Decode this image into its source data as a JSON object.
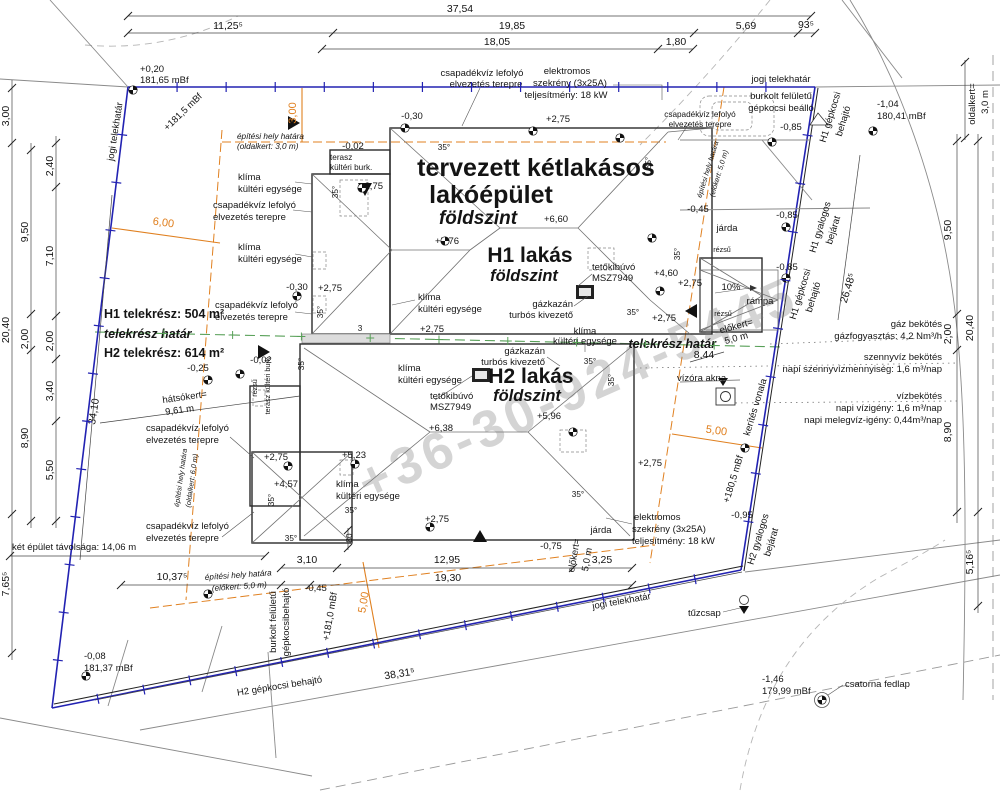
{
  "title": {
    "line1": "tervezett kétlakásos",
    "line2": "lakóépület",
    "line3": "földszint"
  },
  "units": {
    "h1_name": "H1 lakás",
    "h1_floor": "földszint",
    "h2_name": "H2 lakás",
    "h2_floor": "földszint"
  },
  "plots": {
    "h1": "H1 telekrész: 504 m²",
    "h2": "H2 telekrész: 614 m²",
    "division": "telekrész határ"
  },
  "boundary": {
    "legal": "jogi telekhatár",
    "fence": "kerítés vonala"
  },
  "site": {
    "building_limit": "építési hely határa",
    "oldalkert3": "(oldalkert: 3,0 m)",
    "elokert5": "(előkert: 5,0 m)",
    "oldalkert6": "(oldalkert: 6,0 m)",
    "oldalkert_eq": "oldalkert=",
    "oldalkert_val": "3,0 m",
    "elokert_eq": "előkert=",
    "elokert_val": "5,0 m",
    "hatsokert_eq": "hátsókert=",
    "hatsokert_val": "9,61 m",
    "distance": "két épület távolsága: 14,06 m",
    "parking1": "burkolt felületű",
    "parking2": "gépkocsi beálló",
    "driveway1": "burkolt felületű",
    "driveway2": "gépkocsibehajtó"
  },
  "access": {
    "h1_car1": "H1 gépkocsi",
    "h1_car2": "behajtó",
    "h1_ped1": "H1 gyalogos",
    "h1_ped2": "bejárat",
    "h2_car": "H2 gépkocsi behajtó",
    "h2_ped1": "H2 gyalogos",
    "h2_ped2": "bejárat"
  },
  "annotations": {
    "rain1": "csapadékvíz lefolyó",
    "rain2": "elvezetés terepre",
    "klima1": "klíma",
    "klima2": "kültéri egysége",
    "boiler1": "gázkazán",
    "boiler2": "turbós kivezető",
    "hatch1": "tetőkibúvó",
    "hatch2": "MSZ7949",
    "terasz1": "terasz",
    "terasz2": "kültéri burk.",
    "terasz_burk": "terasz kültéri burk.",
    "rezsu": "rézsű",
    "jarda": "járda",
    "rampa": "rámpa",
    "slope35": "35°",
    "slope10": "10%",
    "elek1": "elektromos",
    "elek2": "szekrény (3x25A)",
    "elek3": "teljesítmény: 18 kW"
  },
  "utilities": {
    "gas1": "gáz bekötés",
    "gas2": "gázfogyasztás: 4,2 Nm³/h",
    "sewer1": "szennyvíz bekötés",
    "sewer2": "napi szennyvízmennyiség: 1,6 m³/nap",
    "water1": "vízbekötés",
    "water2": "napi vízigény: 1,6 m³/nap",
    "water3": "napi melegvíz-igény: 0,44m³/nap",
    "meter": "vízóra akna",
    "hydrant": "tűzcsap",
    "manhole": "csatorna fedlap"
  },
  "elevations": {
    "tl1": "+0,20",
    "tl2": "181,65 mBf",
    "tr1": "-1,04",
    "tr2": "180,41 mBf",
    "bl1": "-0,08",
    "bl2": "181,37 mBf",
    "br1": "-1,46",
    "br2": "179,99 mBf",
    "left_bd": "+181,5 mBf",
    "bottom_bd": "+181,0 mBf",
    "right_bd": "+180,5 mBf"
  },
  "levels": {
    "p275": "+2,75",
    "p660": "+6,60",
    "p576": "+5,76",
    "p460": "+4,60",
    "p638": "+6,38",
    "p596": "+5,96",
    "p523": "+5,23",
    "p457": "+4,57",
    "m002": "-0,02",
    "m025": "-0,25",
    "m030": "-0,30",
    "m045": "-0,45",
    "m075": "-0,75",
    "m085": "-0,85",
    "m095": "-0,95"
  },
  "dims": {
    "d3754": "37,54",
    "d1125": "11,25⁵",
    "d1985": "19,85",
    "d569": "5,69",
    "d935": "93⁵",
    "d1805": "18,05",
    "d180": "1,80",
    "d300": "3,00",
    "d240": "2,40",
    "d950": "9,50",
    "d710": "7,10",
    "d2040": "20,40",
    "d200": "2,00",
    "d340": "3,40",
    "d890": "8,90",
    "d550": "5,50",
    "d7655": "7,65⁵",
    "d3410": "34,10",
    "d5165": "5,16⁵",
    "d26485": "26,48⁵",
    "d844": "8,44",
    "d310": "3,10",
    "d1295": "12,95",
    "d1930": "19,30",
    "d325": "3,25",
    "d38315": "38,31⁵",
    "d10375": "10,37⁵",
    "d80": "80",
    "d3": "3",
    "o300": "3,00",
    "o600": "6,00",
    "o500": "5,00"
  },
  "watermark": "+36-30-924-5445",
  "colors": {
    "boundary": "#2222b2",
    "limit": "#e08020",
    "division": "#58a058",
    "dim": "#333333"
  }
}
